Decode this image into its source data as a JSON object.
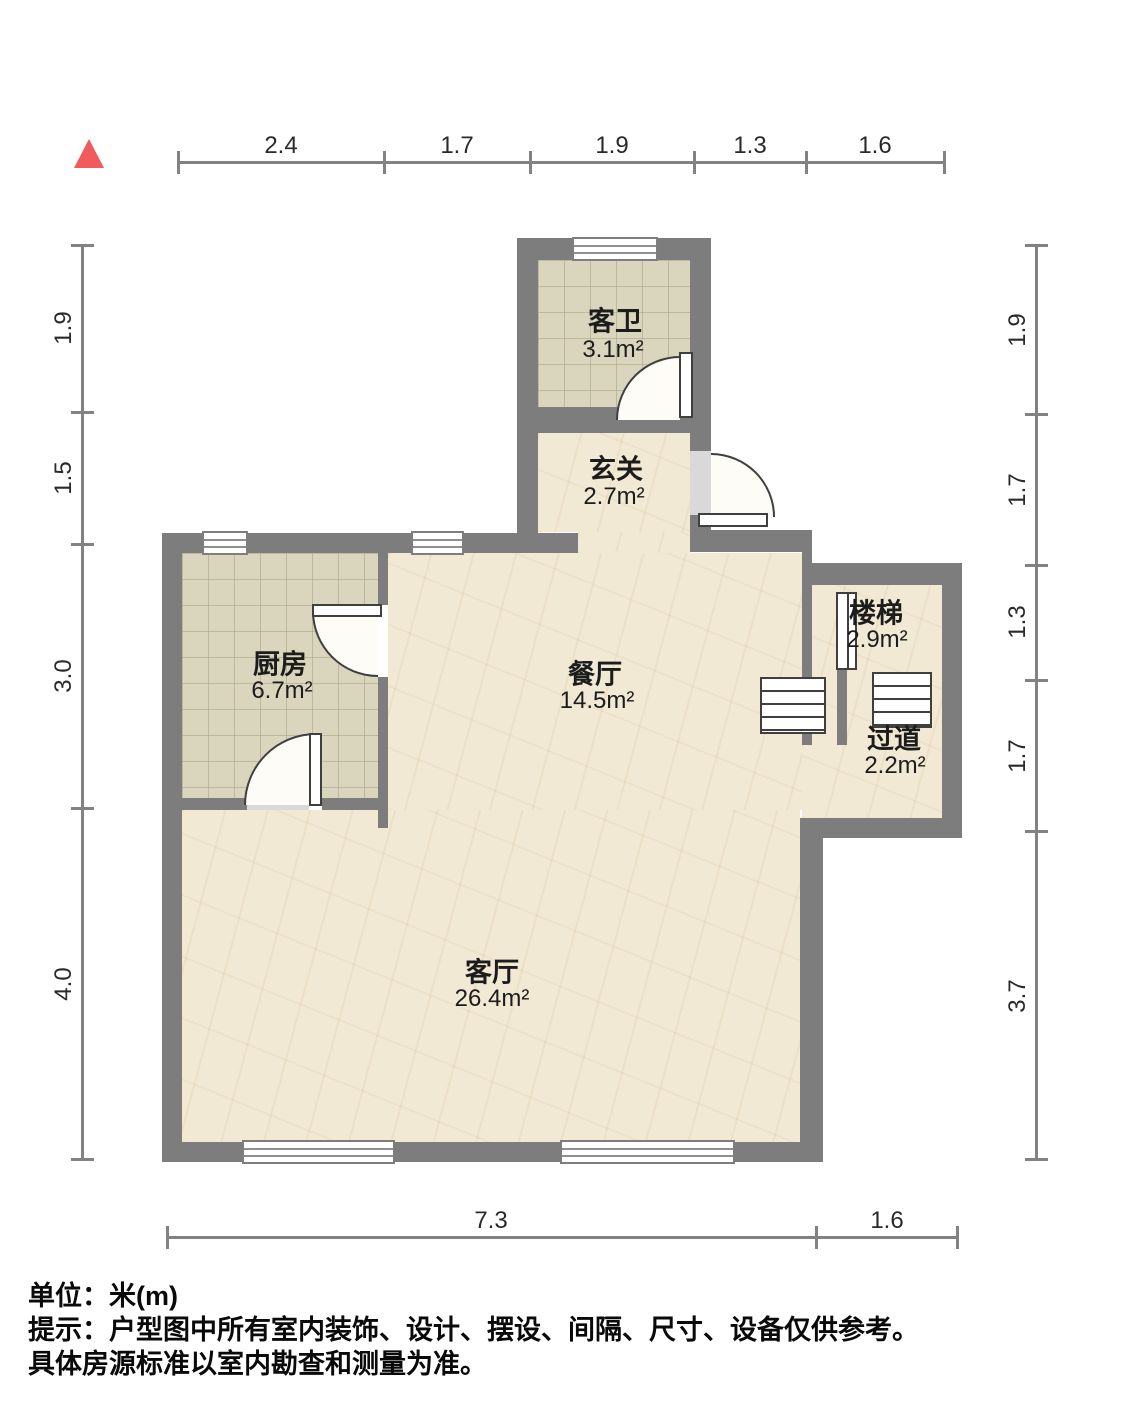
{
  "compass": {
    "description": "north-indicator-triangle"
  },
  "dimensions": {
    "top": [
      "2.4",
      "1.7",
      "1.9",
      "1.3",
      "1.6"
    ],
    "left": [
      "1.9",
      "1.5",
      "3.0",
      "4.0"
    ],
    "right": [
      "1.9",
      "1.7",
      "1.3",
      "1.7",
      "3.7"
    ],
    "bottom": [
      "7.3",
      "1.6"
    ]
  },
  "rooms": {
    "bathroom": {
      "name": "客卫",
      "area": "3.1m²"
    },
    "foyer": {
      "name": "玄关",
      "area": "2.7m²"
    },
    "kitchen": {
      "name": "厨房",
      "area": "6.7m²"
    },
    "dining": {
      "name": "餐厅",
      "area": "14.5m²"
    },
    "stairs": {
      "name": "楼梯",
      "area": "2.9m²"
    },
    "corridor": {
      "name": "过道",
      "area": "2.2m²"
    },
    "living": {
      "name": "客厅",
      "area": "26.4m²"
    }
  },
  "notes": {
    "unit": "单位：米(m)",
    "tip_line1": "提示：户型图中所有室内装饰、设计、摆设、间隔、尺寸、设备仅供参考。",
    "tip_line2": "具体房源标准以室内勘查和测量为准。"
  },
  "colors": {
    "wall": "#7d7d7d",
    "marble_floor": "#f2e9d5",
    "tile_floor": "#d9d6bd",
    "north_marker": "#f15b5b",
    "dimension_line": "#828282"
  }
}
